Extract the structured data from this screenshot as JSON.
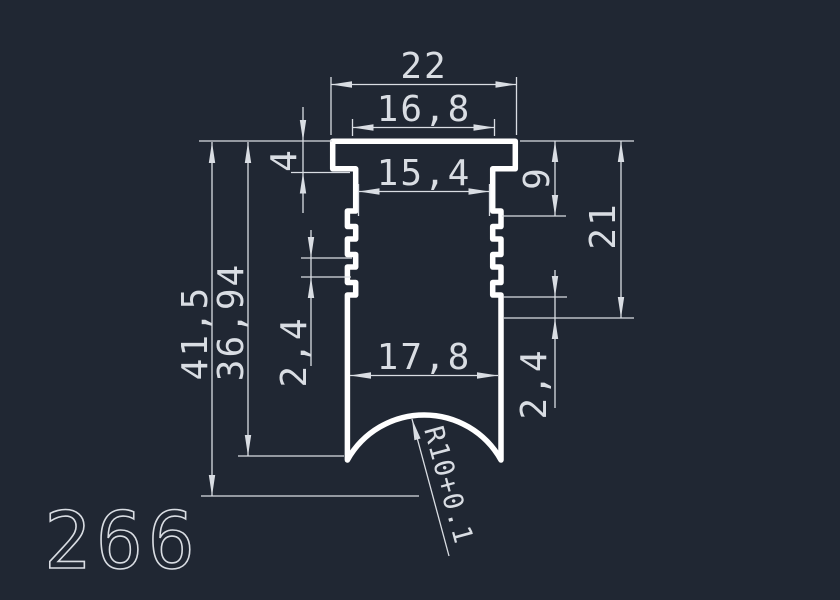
{
  "drawing": {
    "number": "266",
    "background_color": "#202733",
    "profile_line_color": "#ffffff",
    "dimension_line_color": "#d9dde3"
  },
  "dimensions": {
    "flange_width": "22",
    "neck_outer_width": "16,8",
    "neck_inner_width": "15,4",
    "flange_thickness": "4",
    "top_to_ribs_height": "9",
    "rib_zone_height": "21",
    "total_height": "41,5",
    "body_height": "36,94",
    "rib_pitch_left": "2,4",
    "bottom_inner_width": "17,8",
    "last_rib_height": "2,4",
    "bottom_radius_note": "R10+0.1"
  }
}
